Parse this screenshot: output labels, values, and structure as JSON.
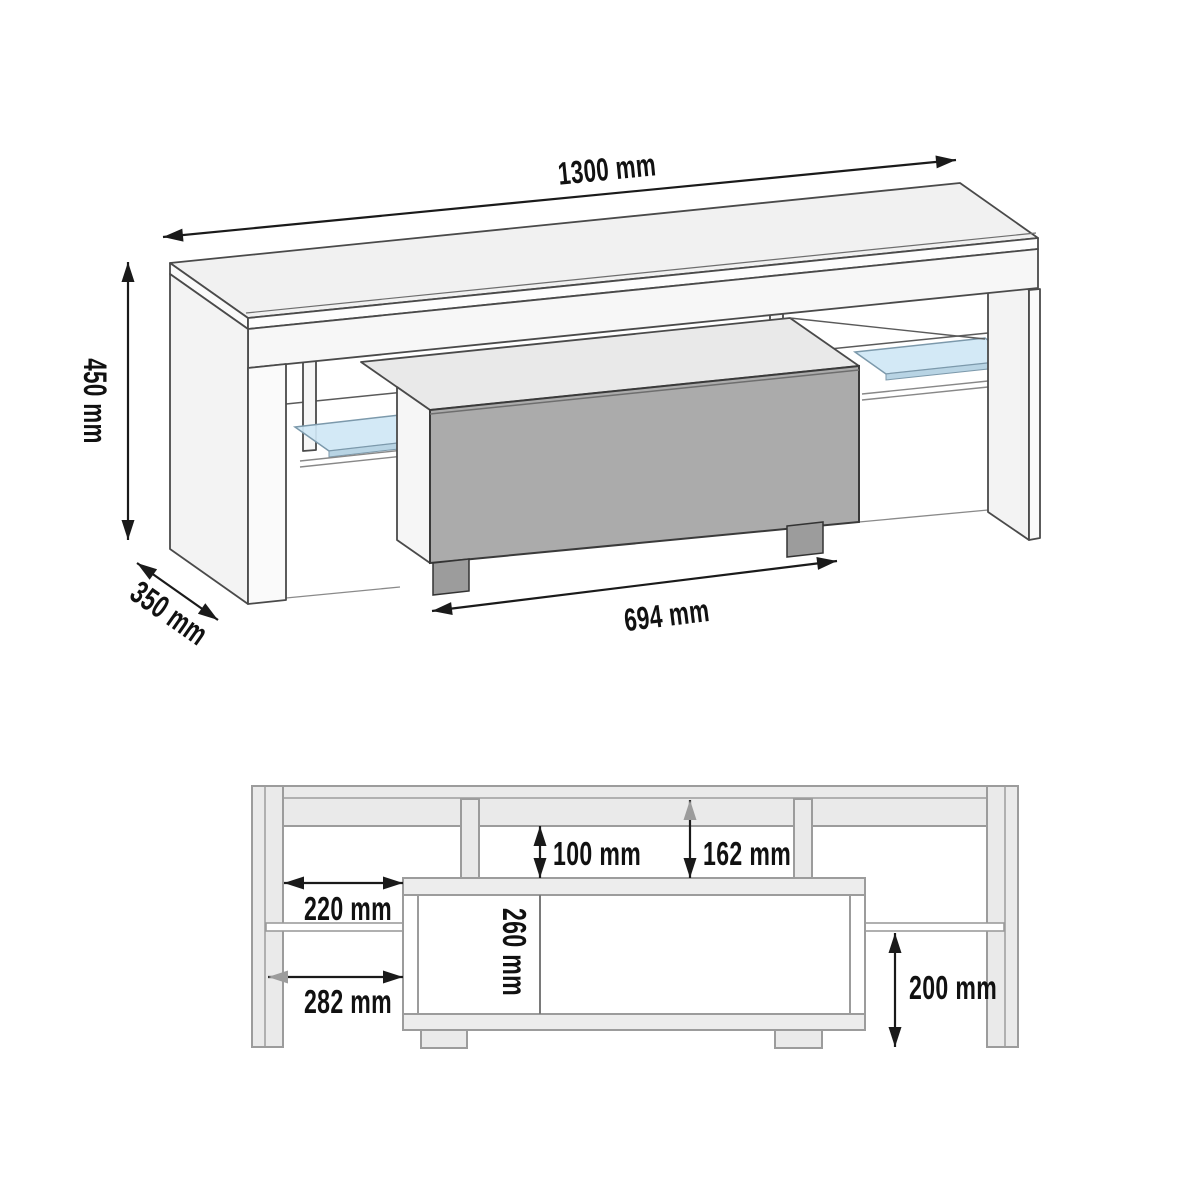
{
  "diagram": {
    "type": "furniture-dimension-diagram",
    "subject": "TV stand with drawer and glass shelves",
    "views": {
      "isometric": {
        "name": "isometric-view",
        "dimensions": {
          "width": "1300 mm",
          "height": "450 mm",
          "depth": "350 mm",
          "drawer_width": "694 mm"
        }
      },
      "front": {
        "name": "front-section-view",
        "dimensions": {
          "top_gap": "100 mm",
          "top_offset": "162 mm",
          "side_gap": "220 mm",
          "side_offset": "282 mm",
          "drawer_inner_height": "260 mm",
          "shelf_clearance": "200 mm"
        }
      }
    },
    "colors": {
      "background": "#ffffff",
      "iso_outline": "#4a4a4a",
      "front_outline": "#9c9c9c",
      "panel_fill_light": "#f1f1f1",
      "panel_fill_front_view": "#eaeaea",
      "drawer_front_gray": "#ababab",
      "drawer_foot_gray": "#9c9c9c",
      "glass_shelf_blue": "#cfe7f5",
      "dimension_black": "#1a1a1a",
      "dimension_gray_arrow": "#9c9c9c"
    }
  }
}
